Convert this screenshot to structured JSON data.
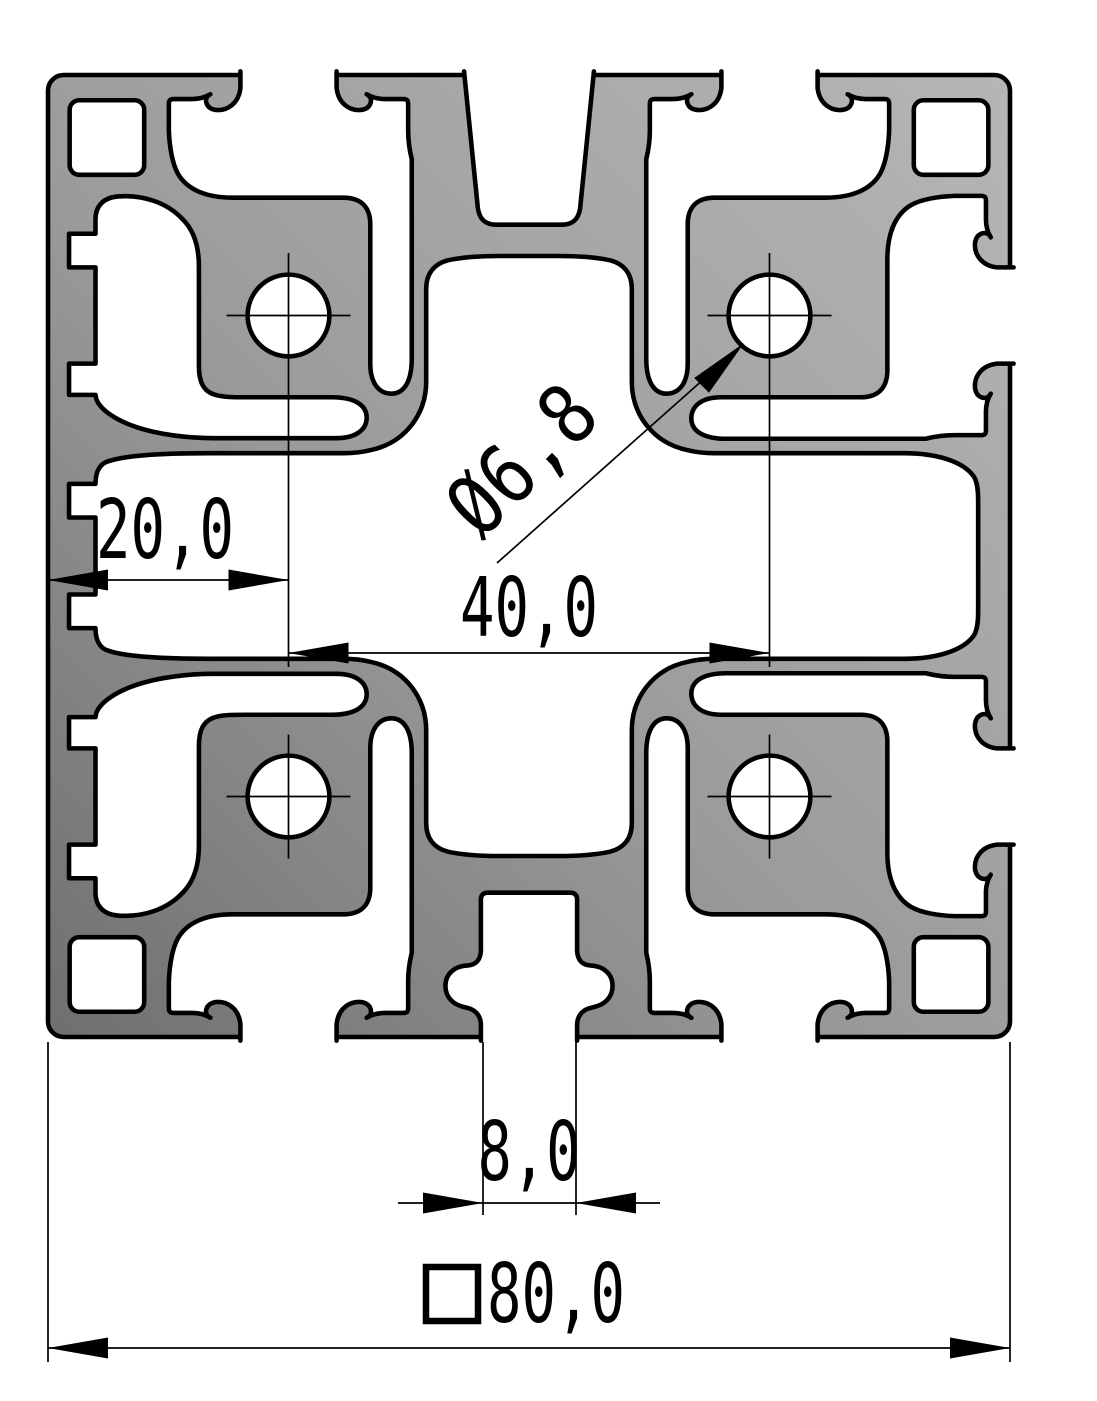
{
  "drawing": {
    "kind": "aluminium-extrusion-profile-cross-section",
    "dimensions": {
      "edge_to_hole": "20,0",
      "hole_to_hole": "40,0",
      "core_hole": "Ø6,8",
      "slot_width": "8,0",
      "overall_size": "80,0"
    },
    "colors": {
      "background": "#ffffff",
      "line": "#000000",
      "profile_fill_dark": "#747474",
      "profile_fill_mid": "#9b9b9b",
      "profile_fill_light": "#b6b6b6"
    }
  }
}
